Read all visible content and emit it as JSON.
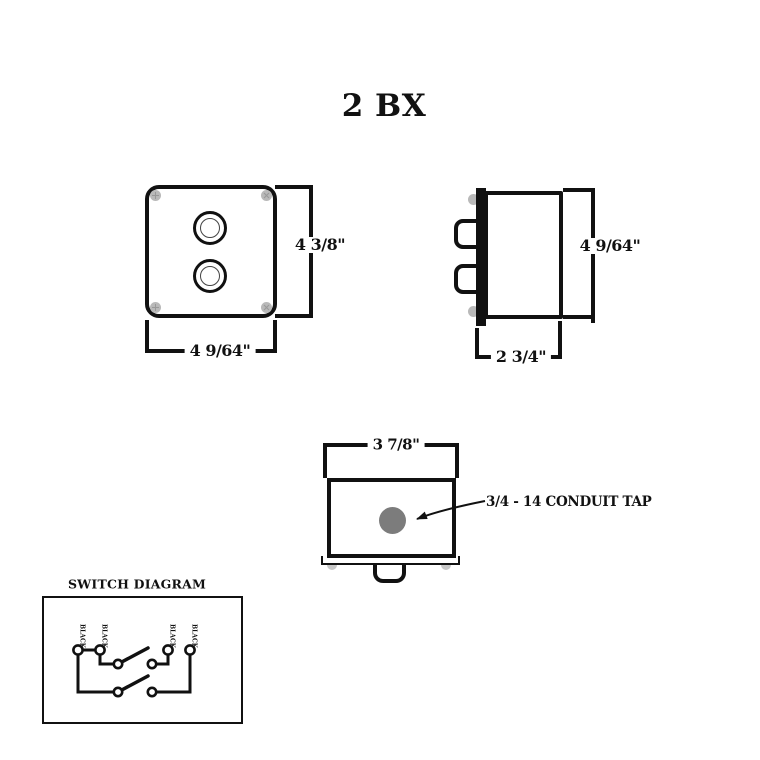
{
  "title": "2 BX",
  "views": {
    "front": {
      "height_label": "4 3/8\"",
      "width_label": "4 9/64\""
    },
    "side": {
      "height_label": "4 9/64\"",
      "depth_label": "2 3/4\""
    },
    "bottom": {
      "width_label": "3 7/8\"",
      "conduit_label": "3/4 - 14 CONDUIT TAP"
    }
  },
  "switch_diagram": {
    "title": "SWITCH DIAGRAM",
    "terminal_labels": [
      "BLACK",
      "BLACK",
      "BLACK",
      "BLACK"
    ]
  },
  "colors": {
    "line": "#111111",
    "screw_gray": "#b9b9b9",
    "conduit_tap_gray": "#7c7c7c",
    "nub_gray": "#c8c8c8"
  }
}
